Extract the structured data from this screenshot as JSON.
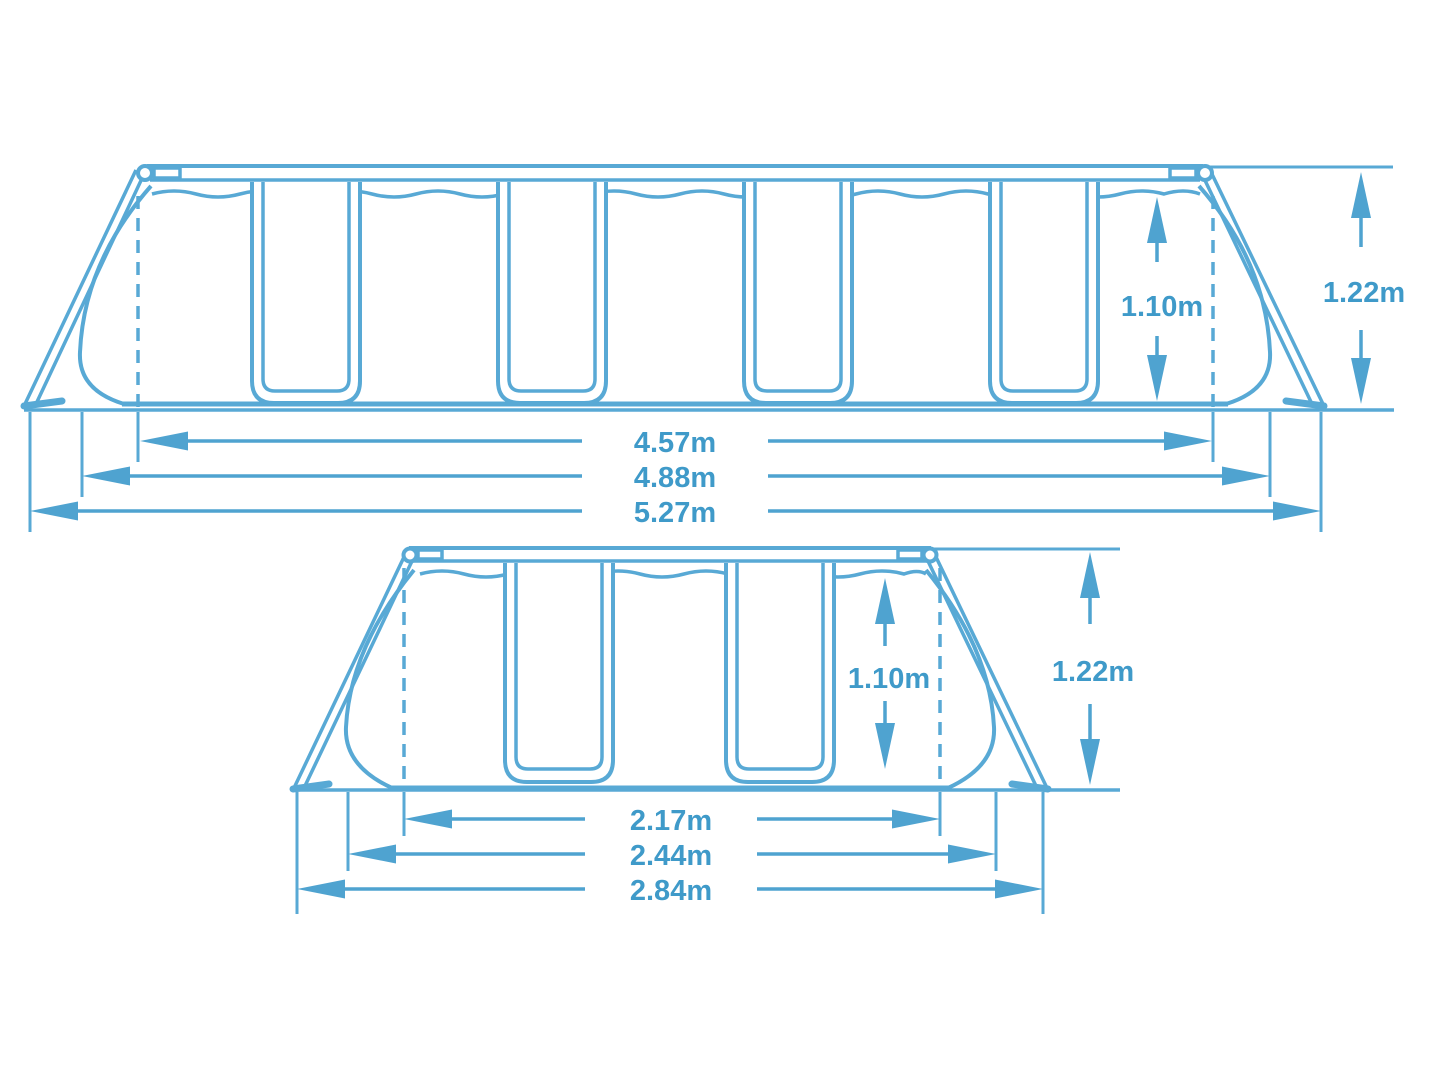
{
  "diagram_title": "pool frame dimensions drawing",
  "colors": {
    "line": "#58a9d5",
    "dimension": "#4fa3d0",
    "text": "#3f9ac9",
    "background": "#ffffff"
  },
  "side_view": {
    "inner_width": "4.57m",
    "base_width": "4.88m",
    "outer_width": "5.27m",
    "water_depth": "1.10m",
    "frame_height": "1.22m"
  },
  "end_view": {
    "inner_width": "2.17m",
    "base_width": "2.44m",
    "outer_width": "2.84m",
    "water_depth": "1.10m",
    "frame_height": "1.22m"
  }
}
